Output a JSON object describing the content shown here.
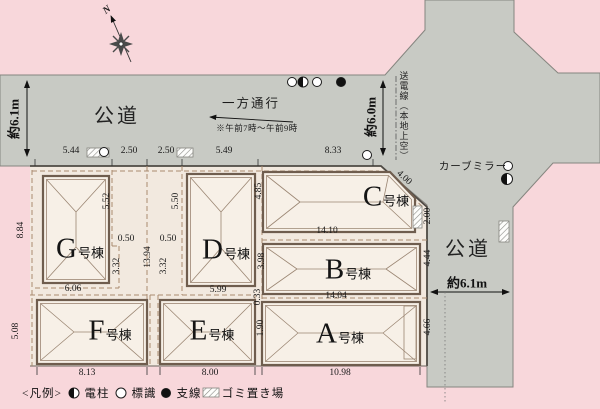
{
  "compass": {
    "north": "N"
  },
  "roads": {
    "west": {
      "label": "公道",
      "width": "約6.1m"
    },
    "north": {
      "width": "約6.0m",
      "power_line": "送電線（本地上空）"
    },
    "east": {
      "label": "公道",
      "width": "約6.1m",
      "curve_mirror": "カーブミラー"
    },
    "one_way": {
      "label": "一方通行",
      "note": "※午前7時～午前9時"
    }
  },
  "lots": {
    "a": {
      "letter": "A",
      "suffix": "号棟"
    },
    "b": {
      "letter": "B",
      "suffix": "号棟"
    },
    "c": {
      "letter": "C",
      "suffix": "号棟"
    },
    "d": {
      "letter": "D",
      "suffix": "号棟"
    },
    "e": {
      "letter": "E",
      "suffix": "号棟"
    },
    "f": {
      "letter": "F",
      "suffix": "号棟"
    },
    "g": {
      "letter": "G",
      "suffix": "号棟"
    }
  },
  "dims": {
    "g_top": "5.44",
    "gap_left": "2.50",
    "gap_right": "2.50",
    "d_top": "5.49",
    "c_top": "8.33",
    "g_left": "8.84",
    "f_left": "5.08",
    "g_right_upper": "5.52",
    "g_setback": "0.50",
    "g_right_lower": "3.32",
    "g_bottom": "6.06",
    "corridor": "13.94",
    "d_left_upper": "5.50",
    "d_setback": "0.50",
    "d_left_lower": "3.32",
    "d_right_upper": "4.85",
    "d_right_lower": "3.98",
    "d_bottom": "5.99",
    "c_diagonal": "4.00",
    "c_right": "2.00",
    "cb_boundary": "14.10",
    "b_right": "4.44",
    "ba_boundary": "14.04",
    "a_right": "4.66",
    "ea_upper": "0.33",
    "ea_lower": "1.90",
    "f_bottom": "8.13",
    "e_bottom": "8.00",
    "a_bottom": "10.98"
  },
  "legend": {
    "title": "<凡例>",
    "items": [
      {
        "icon": "utility-pole-icon",
        "label": "電柱"
      },
      {
        "icon": "sign-icon",
        "label": "標識"
      },
      {
        "icon": "guy-wire-icon",
        "label": "支線"
      },
      {
        "icon": "garbage-area-icon",
        "label": "ゴミ置き場"
      }
    ]
  },
  "colors": {
    "background_pink": "#f8d7db",
    "road_gray": "#c8cac4",
    "lot_cream": "#f2e9df",
    "building_fill": "#f7f0e7",
    "building_outline": "#6f5d4e",
    "boundary_dash": "#a98a6f"
  }
}
